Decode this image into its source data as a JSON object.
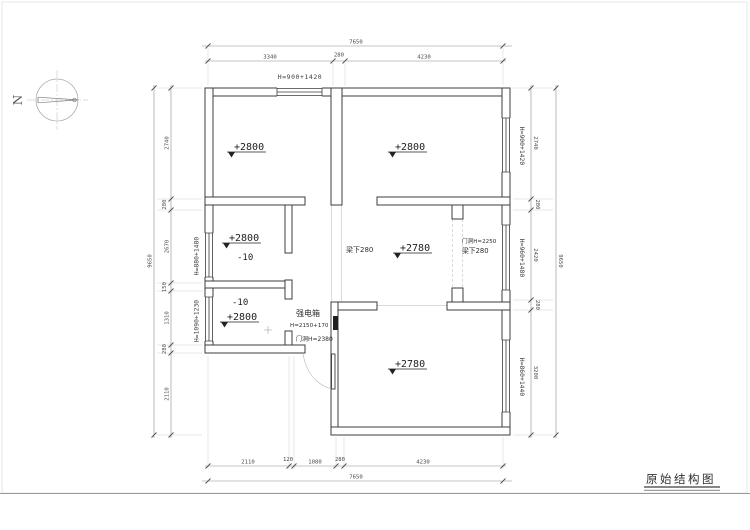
{
  "sheet": {
    "title": "原始结构图"
  },
  "compass": {
    "label": "N"
  },
  "rooms": {
    "top_left_level": "+2800",
    "top_right_level": "+2800",
    "mid_left_level": "+2800",
    "mid_left_sub": "-10",
    "low_left_sub": "-10",
    "low_left_level": "+2800",
    "hall_level": "+2780",
    "bottom_right_level": "+2780"
  },
  "annotations": {
    "beam_hall": "梁下280",
    "corridor_door": "门洞H=2250",
    "beam_corridor": "梁下280",
    "electric_box": "强电箱",
    "electric_box_height": "H=2150+170",
    "entry_door_height": "门洞H=2380"
  },
  "window_labels": {
    "top": "H=900+1420",
    "right_top": "H=900+1420",
    "right_middle": "H=960+1480",
    "right_bottom": "H=860+1440",
    "left_middle": "H=880+1480",
    "left_bottom": "H=1090+1230"
  },
  "dimensions": {
    "top_total": "7650",
    "top_segments": [
      "3340",
      "280",
      "4230"
    ],
    "bottom_segments": [
      "2110",
      "120",
      "1080",
      "280",
      "4230"
    ],
    "bottom_total": "7650",
    "left_segments": [
      "2740",
      "280",
      "2670",
      "150",
      "1310",
      "280",
      "2110"
    ],
    "left_total": "9650",
    "right_segments": [
      "2740",
      "280",
      "2420",
      "280",
      "3200"
    ],
    "right_total": "9650"
  }
}
